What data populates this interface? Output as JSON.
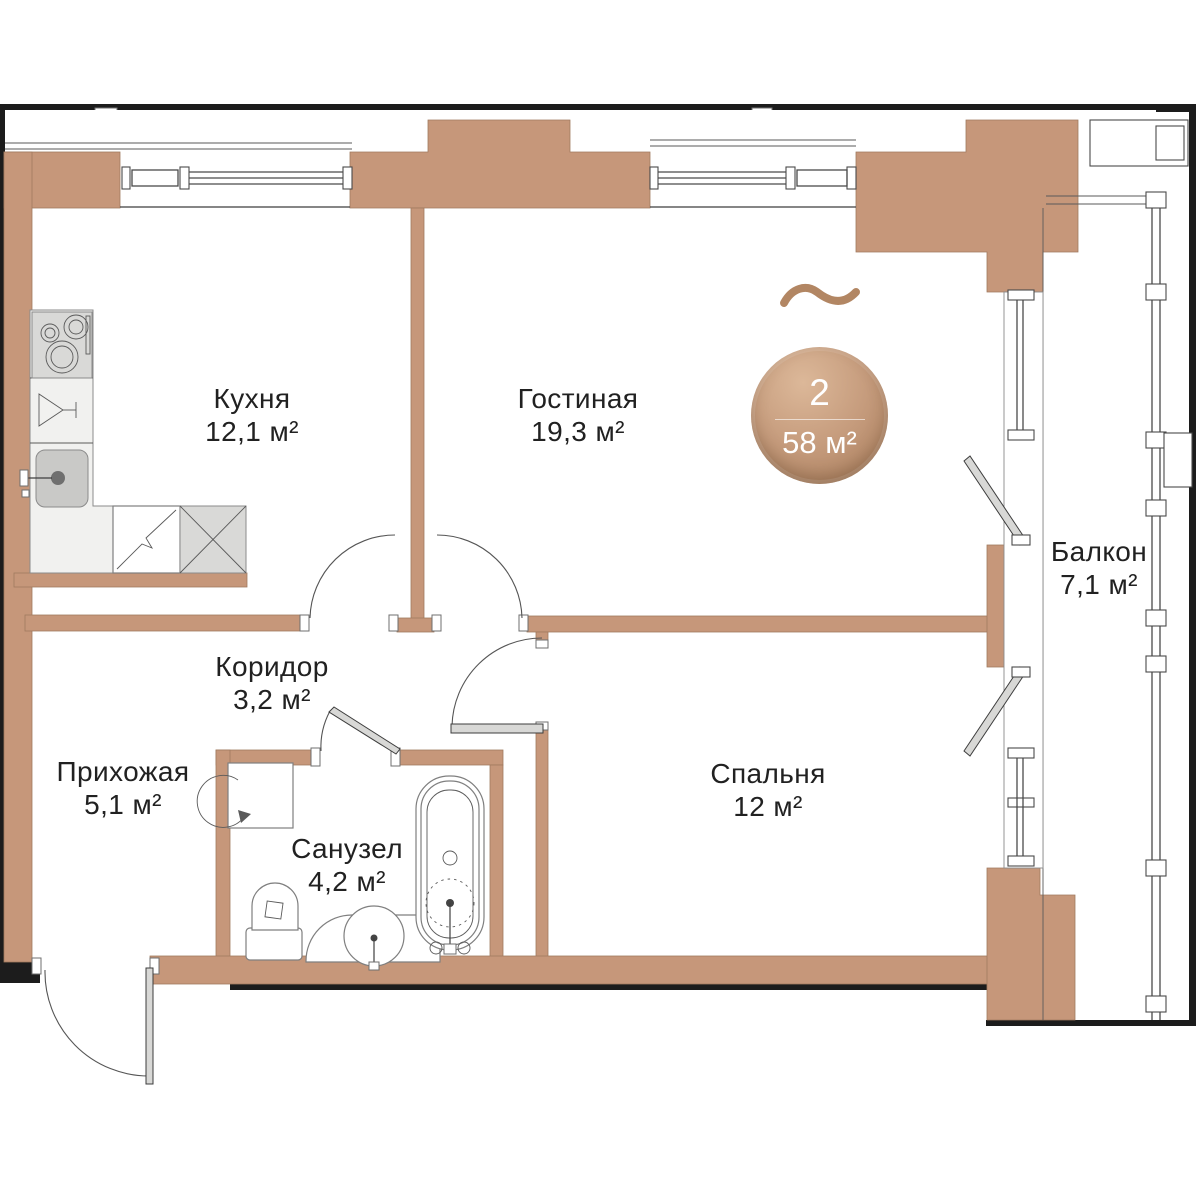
{
  "plan": {
    "badge": {
      "rooms_count": "2",
      "total_area": "58 м²"
    },
    "rooms": [
      {
        "id": "kitchen",
        "name": "Кухня",
        "area": "12,1 м²"
      },
      {
        "id": "living",
        "name": "Гостиная",
        "area": "19,3 м²"
      },
      {
        "id": "balcony",
        "name": "Балкон",
        "area": "7,1 м²"
      },
      {
        "id": "corridor",
        "name": "Коридор",
        "area": "3,2 м²"
      },
      {
        "id": "hallway",
        "name": "Прихожая",
        "area": "5,1 м²"
      },
      {
        "id": "bathroom",
        "name": "Санузел",
        "area": "4,2 м²"
      },
      {
        "id": "bedroom",
        "name": "Спальня",
        "area": "12 м²"
      }
    ],
    "colors": {
      "wall": "#c6977a",
      "outline": "#1c1c1c",
      "accent": "#b28663",
      "badge-light": "#dcb899",
      "badge-dark": "#a87c5b",
      "text": "#212121"
    }
  }
}
